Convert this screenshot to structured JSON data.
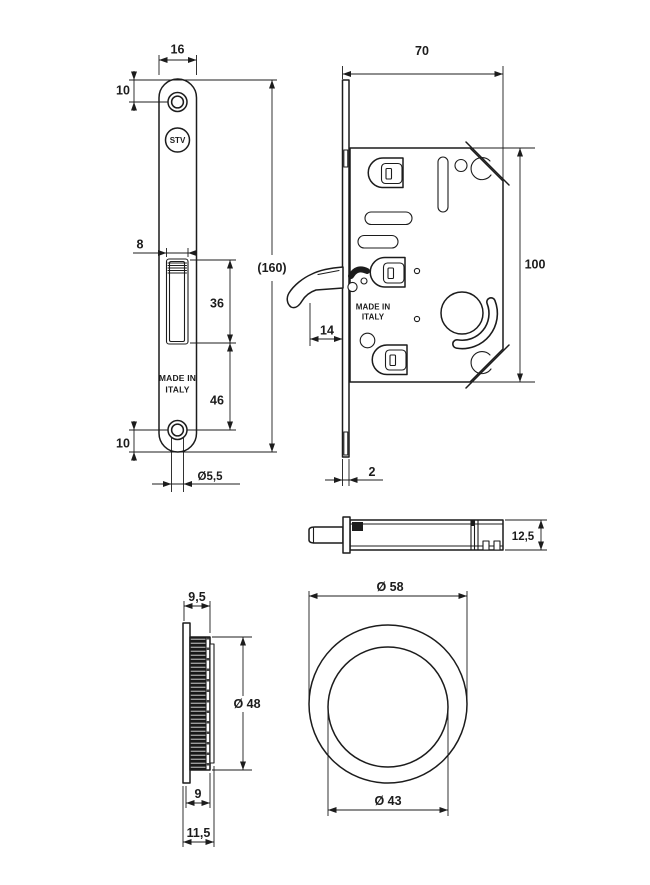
{
  "colors": {
    "line": "#1c1c1c",
    "background": "#ffffff",
    "knurl_dark": "#181818"
  },
  "views": {
    "faceplate_front": {
      "logo": "STV",
      "made_in": [
        "MADE IN",
        "ITALY"
      ],
      "dims": {
        "plate_width": "16",
        "top_screw_offset": "10",
        "overall_length": "(160)",
        "latch_width": "8",
        "latch_length": "36",
        "latch_to_screw": "46",
        "bottom_screw_offset": "10",
        "screw_hole_dia": "Ø5,5"
      }
    },
    "lock_case": {
      "made_in": [
        "MADE IN",
        "ITALY"
      ],
      "dims": {
        "depth": "70",
        "height": "100",
        "hook_projection": "14",
        "faceplate_thickness": "2"
      }
    },
    "case_edge": {
      "dims": {
        "thickness": "12,5"
      }
    },
    "pull_side": {
      "dims": {
        "rim_depth": "9,5",
        "cup_dia": "Ø 48",
        "cup_depth": "9",
        "overall_depth": "11,5"
      }
    },
    "pull_front": {
      "dims": {
        "outer_dia": "Ø 58",
        "inner_dia": "Ø 43"
      }
    }
  }
}
